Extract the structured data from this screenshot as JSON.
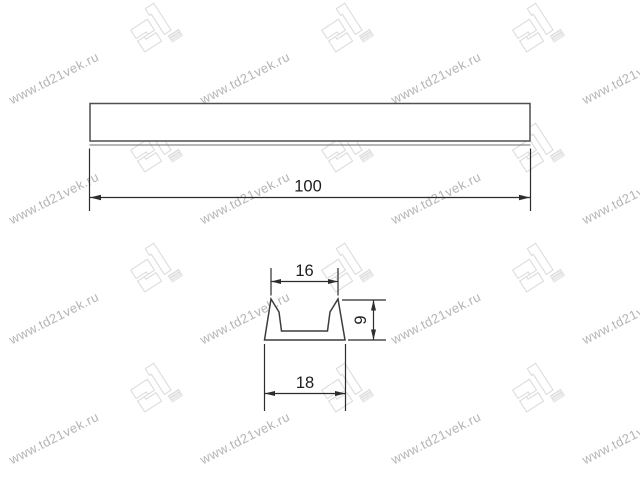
{
  "watermark": {
    "text": "www.td21vek.ru",
    "logo_label": "21",
    "text_color": "#b4b4b4",
    "logo_color": "#dcdcdc",
    "rotation_deg": -27,
    "text_cols": [
      10,
      201,
      392,
      583
    ],
    "text_rows": [
      93,
      213,
      333,
      453
    ],
    "logo_cols": [
      126,
      317,
      508
    ],
    "logo_rows": [
      2,
      122,
      242,
      362
    ]
  },
  "drawing": {
    "line_color": "#2c2c2c",
    "outline_color": "#4f4f4f",
    "labels": {
      "length": "100",
      "top_width": "16",
      "height": "9",
      "bottom_width": "18"
    }
  }
}
